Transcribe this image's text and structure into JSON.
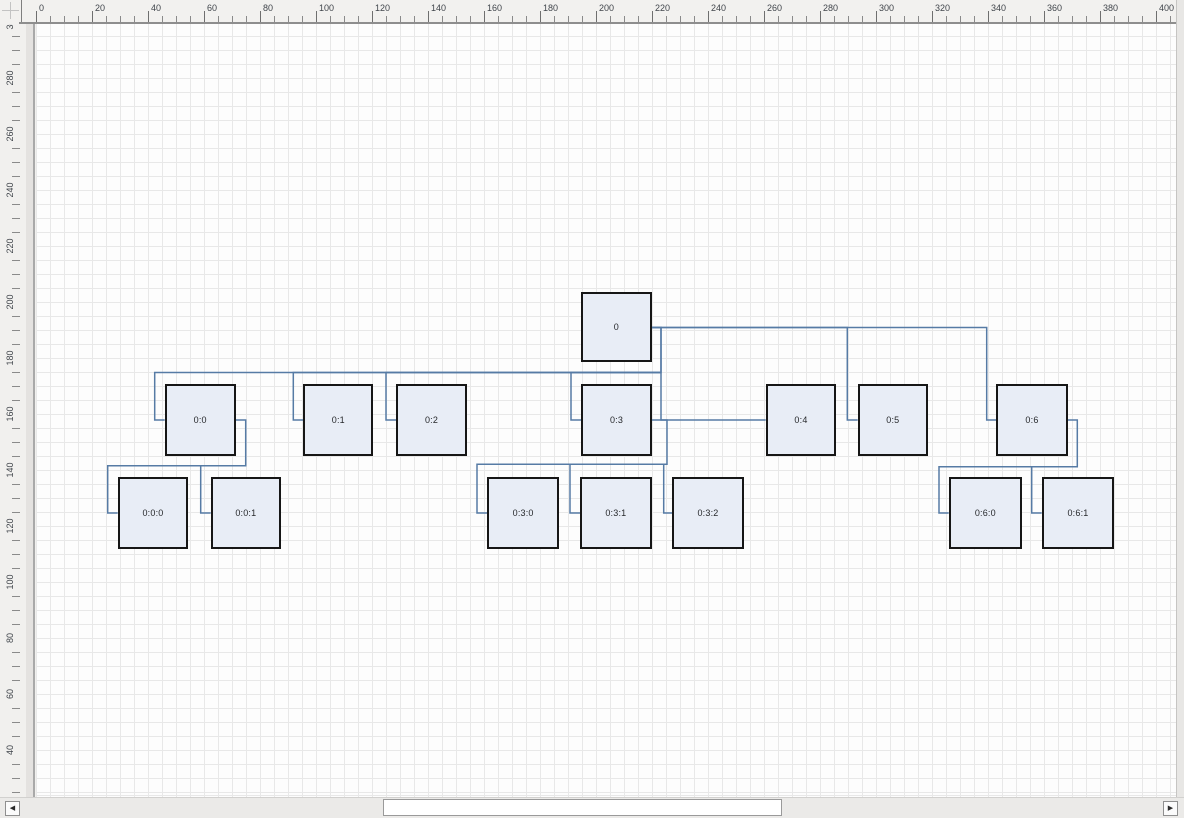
{
  "rulers": {
    "unit_px": 2.8,
    "top": {
      "labels": [
        0,
        20,
        40,
        60,
        80,
        100,
        120,
        140,
        160,
        180,
        200,
        220,
        240,
        260,
        280,
        300,
        320,
        340,
        360,
        380,
        400
      ],
      "minor_step": 5,
      "minor_max": 405
    },
    "left": {
      "labels": [
        300,
        280,
        260,
        240,
        220,
        200,
        180,
        160,
        140,
        120,
        100,
        80,
        60,
        40
      ],
      "minor_step": 5,
      "minor_min": 25,
      "top_unit": 300
    }
  },
  "canvas": {
    "grid_px": 14
  },
  "diagram": {
    "node_fill": "#e8edf6",
    "node_border": "#161616",
    "edge_color": "#567ba5",
    "nodes": [
      {
        "id": "0",
        "label": "0",
        "x": 544.7,
        "y": 268.3,
        "w": 71.3,
        "h": 70
      },
      {
        "id": "0:0",
        "label": "0:0",
        "x": 128.7,
        "y": 360.3,
        "w": 71,
        "h": 72
      },
      {
        "id": "0:1",
        "label": "0:1",
        "x": 267.3,
        "y": 360.3,
        "w": 70,
        "h": 72
      },
      {
        "id": "0:2",
        "label": "0:2",
        "x": 360,
        "y": 360.3,
        "w": 71,
        "h": 72
      },
      {
        "id": "0:3",
        "label": "0:3",
        "x": 545,
        "y": 360.3,
        "w": 71,
        "h": 72
      },
      {
        "id": "0:4",
        "label": "0:4",
        "x": 729.7,
        "y": 360.3,
        "w": 70.6,
        "h": 72
      },
      {
        "id": "0:5",
        "label": "0:5",
        "x": 821.7,
        "y": 360.3,
        "w": 70.3,
        "h": 72
      },
      {
        "id": "0:6",
        "label": "0:6",
        "x": 960.3,
        "y": 360.3,
        "w": 71.4,
        "h": 72
      },
      {
        "id": "0:0:0",
        "label": "0:0:0",
        "x": 81.7,
        "y": 453.3,
        "w": 70.6,
        "h": 71.4
      },
      {
        "id": "0:0:1",
        "label": "0:0:1",
        "x": 174.7,
        "y": 453.3,
        "w": 70.3,
        "h": 71.4
      },
      {
        "id": "0:3:0",
        "label": "0:3:0",
        "x": 451.3,
        "y": 453.3,
        "w": 71.7,
        "h": 71.4
      },
      {
        "id": "0:3:1",
        "label": "0:3:1",
        "x": 544,
        "y": 453.3,
        "w": 71.7,
        "h": 71.4
      },
      {
        "id": "0:3:2",
        "label": "0:3:2",
        "x": 636.3,
        "y": 453.3,
        "w": 71.4,
        "h": 71.4
      },
      {
        "id": "0:6:0",
        "label": "0:6:0",
        "x": 912.7,
        "y": 453.3,
        "w": 73.3,
        "h": 71.4
      },
      {
        "id": "0:6:1",
        "label": "0:6:1",
        "x": 1005.7,
        "y": 453.3,
        "w": 72.6,
        "h": 71.4
      }
    ],
    "edges": [
      {
        "from": "0",
        "to": "0:0",
        "points": [
          [
            616,
            303.5
          ],
          [
            625,
            303.5
          ],
          [
            625,
            348.5
          ],
          [
            118.7,
            348.5
          ],
          [
            118.7,
            396
          ],
          [
            128.7,
            396
          ]
        ]
      },
      {
        "from": "0",
        "to": "0:1",
        "points": [
          [
            625,
            348.5
          ],
          [
            257.3,
            348.5
          ],
          [
            257.3,
            396
          ],
          [
            267.3,
            396
          ]
        ]
      },
      {
        "from": "0",
        "to": "0:2",
        "points": [
          [
            625,
            348.5
          ],
          [
            350,
            348.5
          ],
          [
            350,
            396
          ],
          [
            360,
            396
          ]
        ]
      },
      {
        "from": "0",
        "to": "0:3",
        "points": [
          [
            625,
            348.5
          ],
          [
            535,
            348.5
          ],
          [
            535,
            396
          ],
          [
            545,
            396
          ]
        ]
      },
      {
        "from": "0",
        "to": "0:4",
        "points": [
          [
            616,
            303.5
          ],
          [
            625,
            303.5
          ],
          [
            625,
            396
          ],
          [
            729.7,
            396
          ]
        ]
      },
      {
        "from": "0",
        "to": "0:5",
        "points": [
          [
            616,
            303.5
          ],
          [
            811.3,
            303.5
          ],
          [
            811.3,
            396
          ],
          [
            821.7,
            396
          ]
        ]
      },
      {
        "from": "0",
        "to": "0:6",
        "points": [
          [
            616,
            303.5
          ],
          [
            950.7,
            303.5
          ],
          [
            950.7,
            396
          ],
          [
            960.3,
            396
          ]
        ]
      },
      {
        "from": "0:0",
        "to": "0:0:0",
        "points": [
          [
            199.7,
            396
          ],
          [
            209.7,
            396
          ],
          [
            209.7,
            441.7
          ],
          [
            71.7,
            441.7
          ],
          [
            71.7,
            489
          ],
          [
            81.7,
            489
          ]
        ]
      },
      {
        "from": "0:0",
        "to": "0:0:1",
        "points": [
          [
            209.7,
            441.7
          ],
          [
            164.7,
            441.7
          ],
          [
            164.7,
            489
          ],
          [
            174.7,
            489
          ]
        ]
      },
      {
        "from": "0:3",
        "to": "0:3:0",
        "points": [
          [
            616,
            396
          ],
          [
            631,
            396
          ],
          [
            631,
            440.3
          ],
          [
            441,
            440.3
          ],
          [
            441,
            489
          ],
          [
            451.3,
            489
          ]
        ]
      },
      {
        "from": "0:3",
        "to": "0:3:1",
        "points": [
          [
            631,
            440.3
          ],
          [
            534,
            440.3
          ],
          [
            534,
            489
          ],
          [
            544,
            489
          ]
        ]
      },
      {
        "from": "0:3",
        "to": "0:3:2",
        "points": [
          [
            631,
            440.3
          ],
          [
            627.7,
            440.3
          ],
          [
            627.7,
            489
          ],
          [
            636.3,
            489
          ]
        ]
      },
      {
        "from": "0:6",
        "to": "0:6:0",
        "points": [
          [
            1031.7,
            396
          ],
          [
            1041.3,
            396
          ],
          [
            1041.3,
            442.7
          ],
          [
            903,
            442.7
          ],
          [
            903,
            489
          ],
          [
            912.7,
            489
          ]
        ]
      },
      {
        "from": "0:6",
        "to": "0:6:1",
        "points": [
          [
            1041.3,
            442.7
          ],
          [
            995.7,
            442.7
          ],
          [
            995.7,
            489
          ],
          [
            1005.7,
            489
          ]
        ]
      }
    ]
  },
  "scrollbar": {
    "left_arrow": "◀",
    "right_arrow": "▶",
    "thumb": {
      "x": 383,
      "w": 399
    }
  }
}
